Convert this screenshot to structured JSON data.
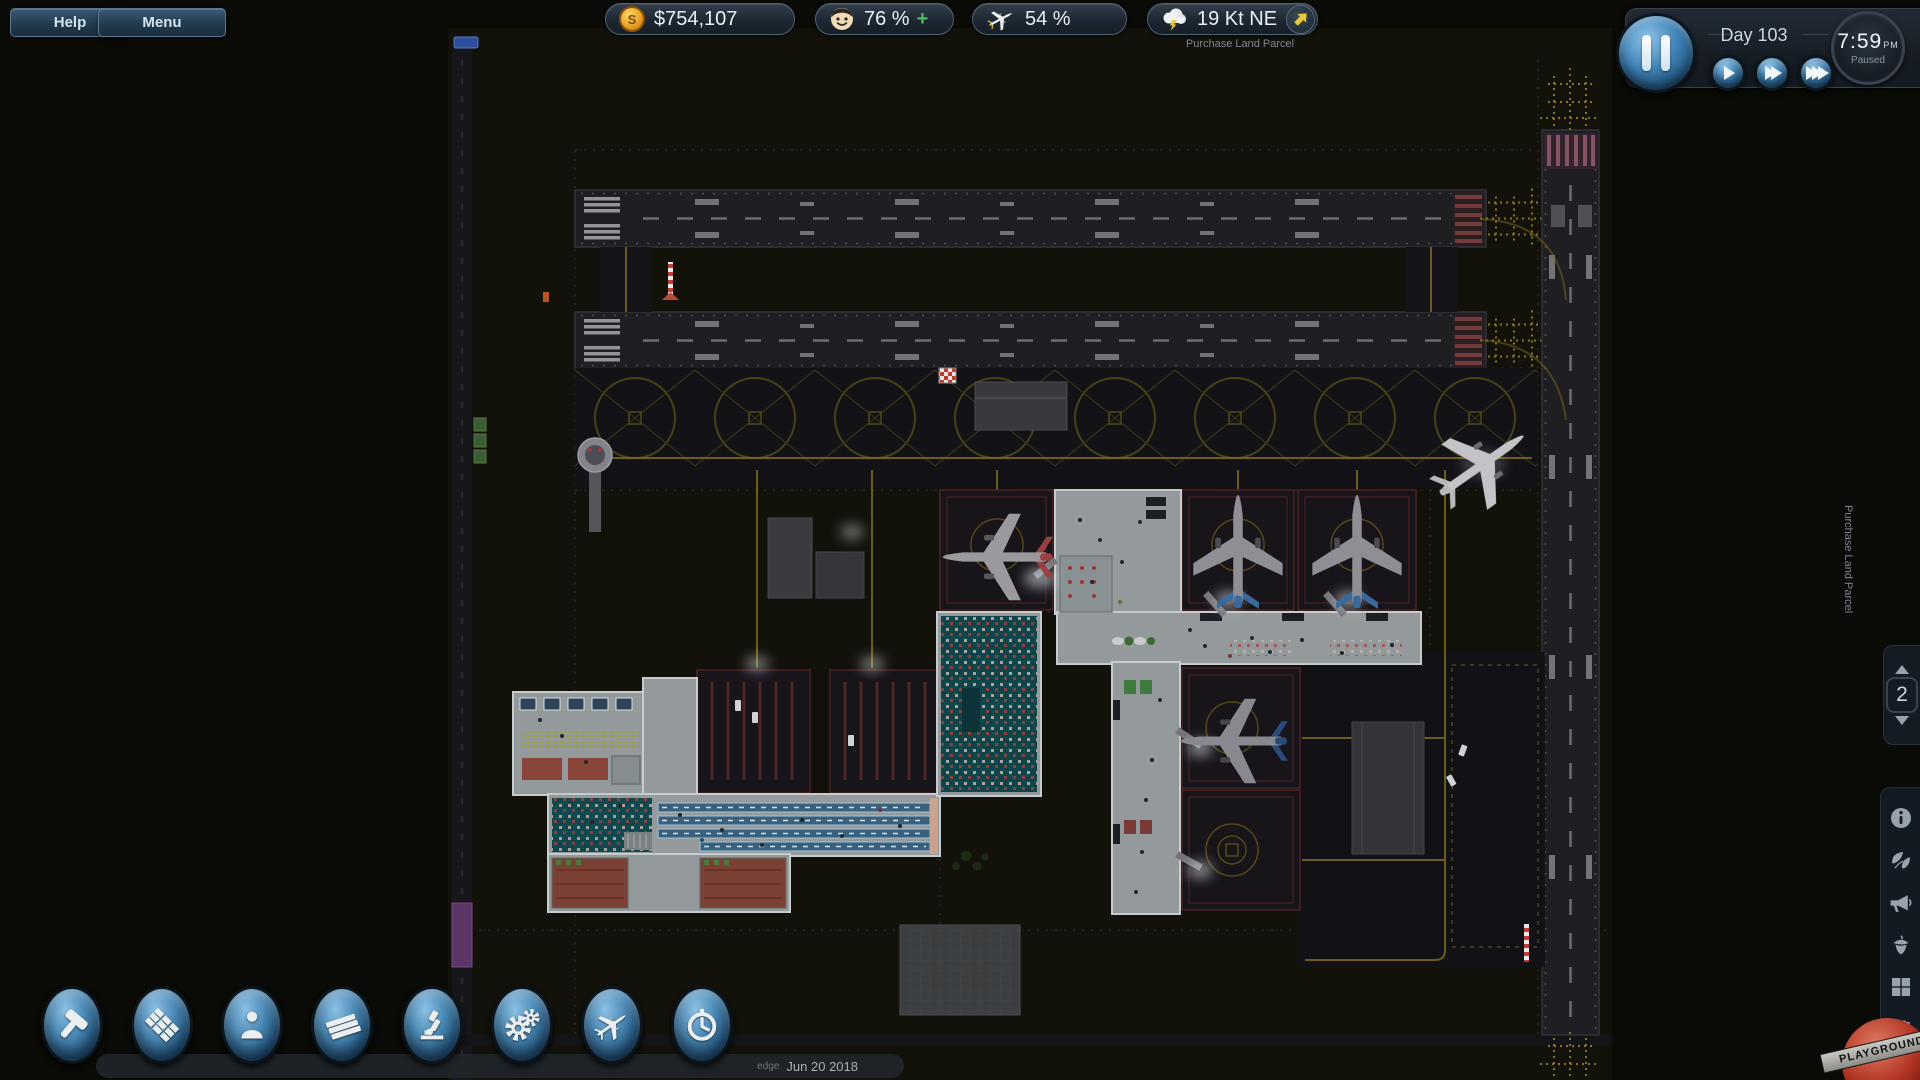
{
  "topbar": {
    "help_label": "Help",
    "menu_label": "Menu",
    "money": {
      "icon": "coin-icon",
      "value": "$754,107"
    },
    "satisfaction": {
      "icon": "passenger-face-icon",
      "value": "76 %",
      "trend": "+"
    },
    "flight_rating": {
      "icon": "airplane-icon",
      "value": "54 %"
    },
    "wind": {
      "icon": "storm-cloud-icon",
      "value": "19 Kt NE",
      "direction": "NE",
      "direction_icon": "northeast-arrow-icon"
    }
  },
  "time_panel": {
    "day_label": "Day 103",
    "time": "7:59",
    "meridiem": "PM",
    "status": "Paused",
    "controls": [
      "pause-icon",
      "play-icon",
      "fast-forward-icon",
      "fastest-forward-icon"
    ]
  },
  "toolbar": {
    "version": "edge",
    "build_date": "Jun 20 2018",
    "tools": [
      {
        "name": "build-tool",
        "icon": "hammer-icon"
      },
      {
        "name": "zones-tool",
        "icon": "tiles-icon"
      },
      {
        "name": "staff-tool",
        "icon": "person-icon"
      },
      {
        "name": "materials-tool",
        "icon": "planks-icon"
      },
      {
        "name": "research-tool",
        "icon": "microscope-icon"
      },
      {
        "name": "operations-tool",
        "icon": "gears-icon"
      },
      {
        "name": "flights-tool",
        "icon": "airplane-icon"
      },
      {
        "name": "schedule-tool",
        "icon": "stopwatch-icon"
      }
    ]
  },
  "right_rail": {
    "floor_selector": {
      "value": "2",
      "up": "up-arrow-icon",
      "down": "down-arrow-icon"
    },
    "panel_icons": [
      "info-icon",
      "leaf-icon",
      "megaphone-icon",
      "acorn-icon",
      "grid-icon",
      "sliders-icon"
    ]
  },
  "map": {
    "land_parcel_label_top": "Purchase Land Parcel",
    "land_parcel_label_right": "Purchase Land Parcel"
  },
  "watermark": {
    "text": "PLAYGROUND"
  },
  "colors": {
    "accent_blue": "#3f81b4",
    "coin_gold": "#e8a32c",
    "positive_green": "#4cc05c",
    "wind_arrow_yellow": "#e9c93a",
    "taxi_line_yellow": "#7c6a1e",
    "panel_dark": "#1d242c"
  }
}
